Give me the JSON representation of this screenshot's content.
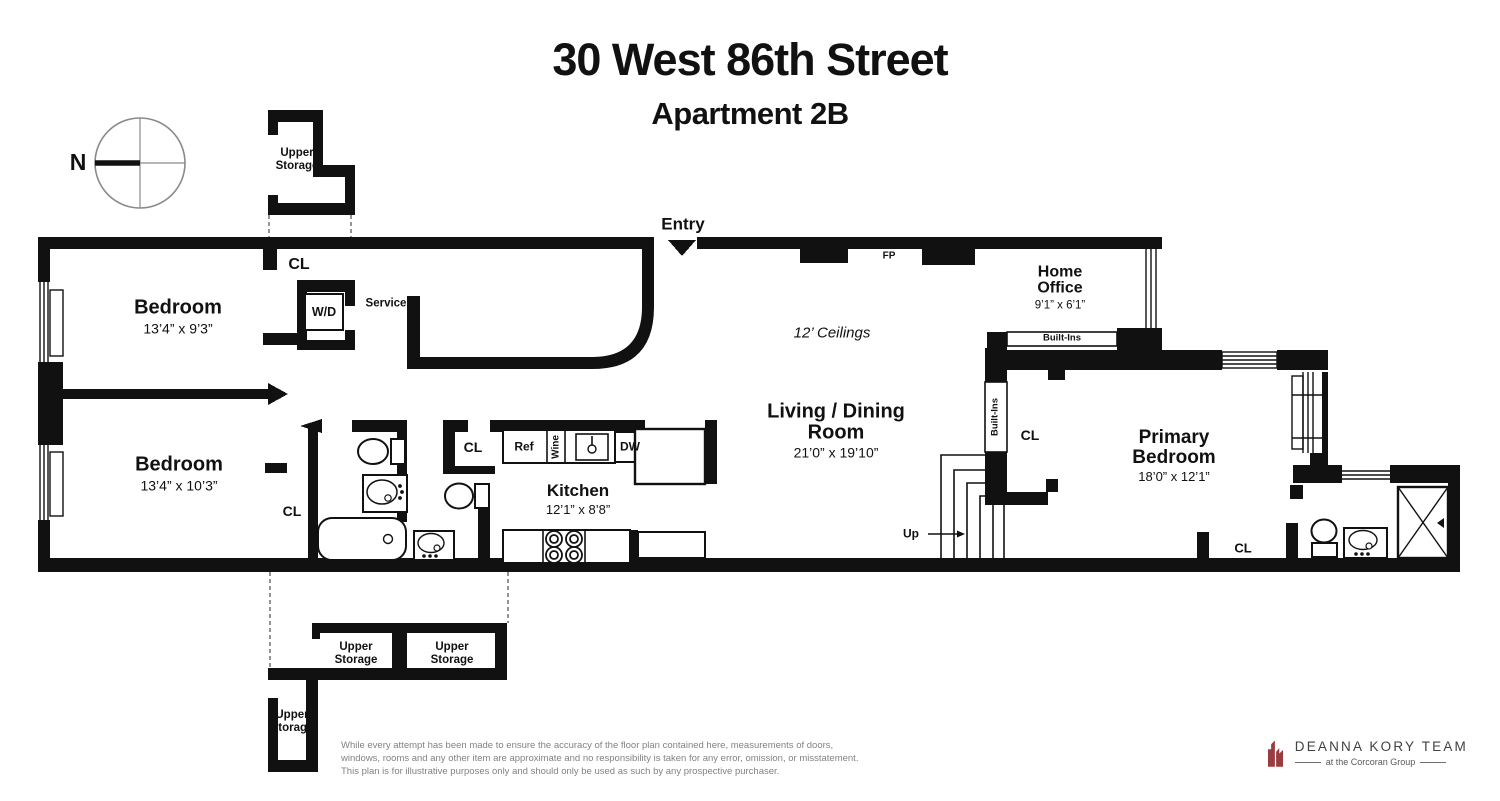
{
  "title": {
    "line1": "30 West 86th Street",
    "line2": "Apartment 2B"
  },
  "compass": {
    "north": "N"
  },
  "labels": {
    "entry": "Entry",
    "service": "Service",
    "fp": "FP",
    "up": "Up",
    "cl": "CL",
    "wd": "W/D",
    "ref": "Ref",
    "wine": "Wine",
    "dw": "DW",
    "built_ins": "Built-Ins",
    "upper_storage": "Upper Storage",
    "ceilings": "12’ Ceilings"
  },
  "rooms": {
    "bedroom1": {
      "name": "Bedroom",
      "dims": "13’4” x 9’3”"
    },
    "bedroom2": {
      "name": "Bedroom",
      "dims": "13’4” x 10’3”"
    },
    "kitchen": {
      "name": "Kitchen",
      "dims": "12’1” x 8’8”"
    },
    "living_dining": {
      "name": "Living / Dining Room",
      "dims": "21’0” x 19’10”"
    },
    "home_office": {
      "name": "Home Office",
      "dims": "9’1” x 6’1”"
    },
    "primary_bedroom": {
      "name": "Primary Bedroom",
      "dims": "18’0” x 12’1”"
    }
  },
  "disclaimer": {
    "line1": "While every attempt has been made to ensure the accuracy of the floor plan contained here, measurements of doors,",
    "line2": "windows, rooms and any other item are approximate and no responsibility is taken for any error, omission, or misstatement.",
    "line3": "This plan is for illustrative purposes only and should only be used as such by any prospective purchaser."
  },
  "branding": {
    "team": "DEANNA KORY TEAM",
    "tagline": "at the Corcoran Group"
  },
  "colors": {
    "plan_ink": "#111111",
    "logo_red": "#993B3F",
    "logo_text": "#414042",
    "disclaimer_gray": "#808285"
  }
}
